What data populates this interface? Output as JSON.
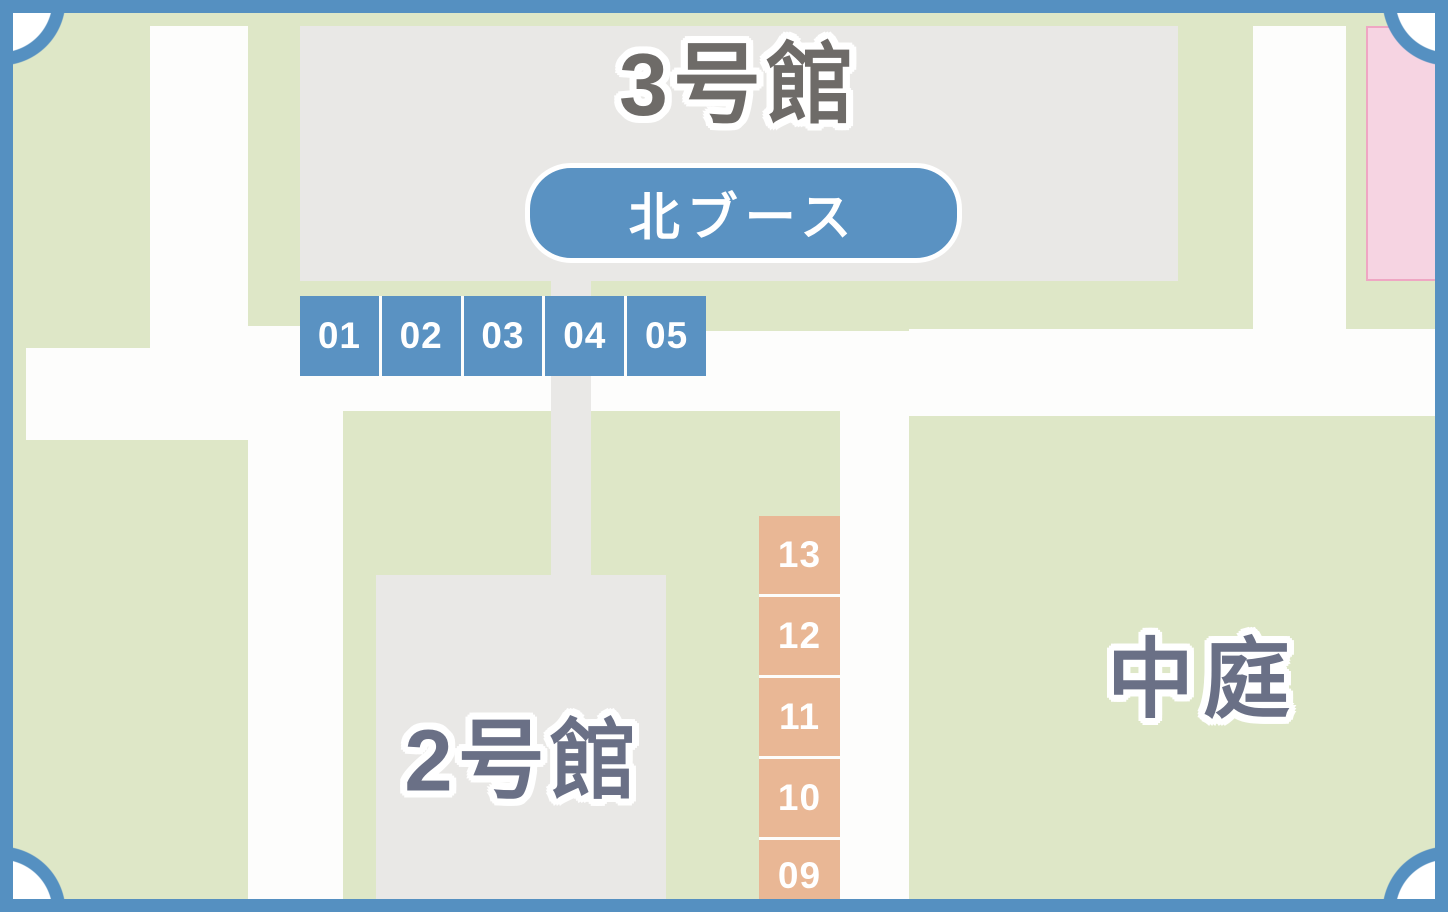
{
  "areas": {
    "building3": {
      "label": "3号館"
    },
    "building2": {
      "label": "2号館"
    },
    "courtyard": {
      "label": "中庭"
    }
  },
  "north_booth_badge": {
    "label": "北ブース"
  },
  "booths_top": {
    "items": [
      "01",
      "02",
      "03",
      "04",
      "05"
    ]
  },
  "booths_right": {
    "items": [
      "13",
      "12",
      "11",
      "10",
      "09"
    ]
  },
  "colors": {
    "frame_blue": "#5590c1",
    "booth_blue": "#5a92c2",
    "badge_blue": "#5a92c2",
    "booth_orange": "#e9b795",
    "grass_green": "#dee7c7",
    "path_white": "#fdfdfc",
    "building_gray": "#e9e8e6",
    "pink_fill": "#f6d4e2",
    "pink_border": "#efa6c3",
    "label_gray": "#6e6b68",
    "label_slate": "#6a7086",
    "number_text": "#ffffff"
  }
}
